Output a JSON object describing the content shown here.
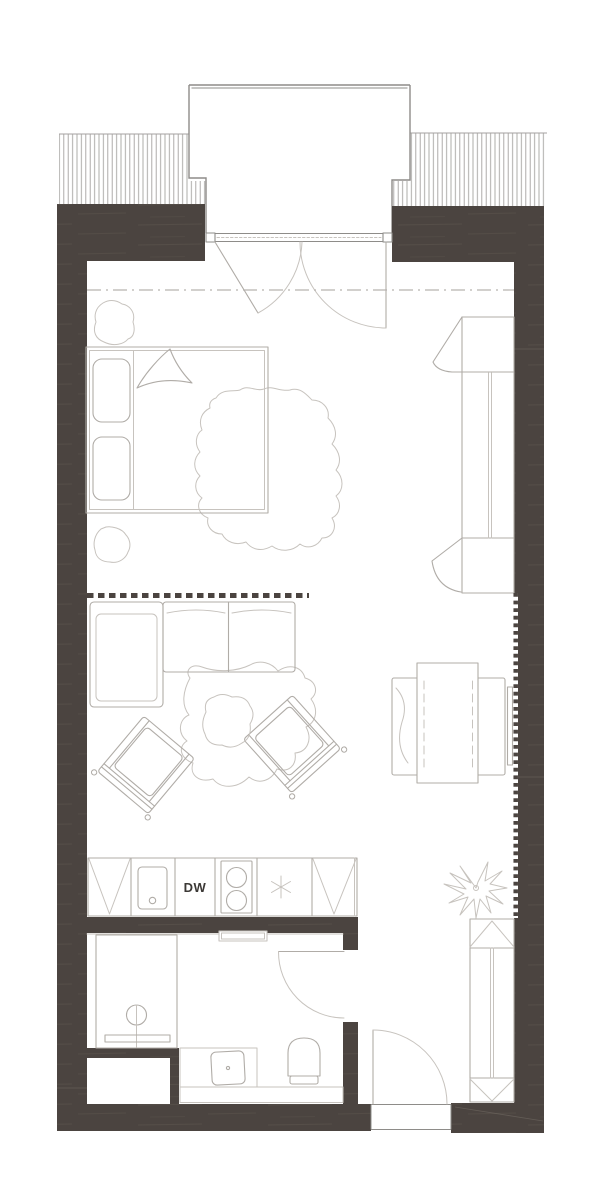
{
  "labels": {
    "dishwasher": "DW"
  },
  "colors": {
    "wall": "#4b4440",
    "streak": "#59524b",
    "outline": "#b0aca7",
    "outline_light": "#c7c3be",
    "structure": "#8e8c89",
    "hatch": "#a4a2a0",
    "dash": "#b7b3af",
    "seam": "#6b645d",
    "text": "#3c3936"
  }
}
